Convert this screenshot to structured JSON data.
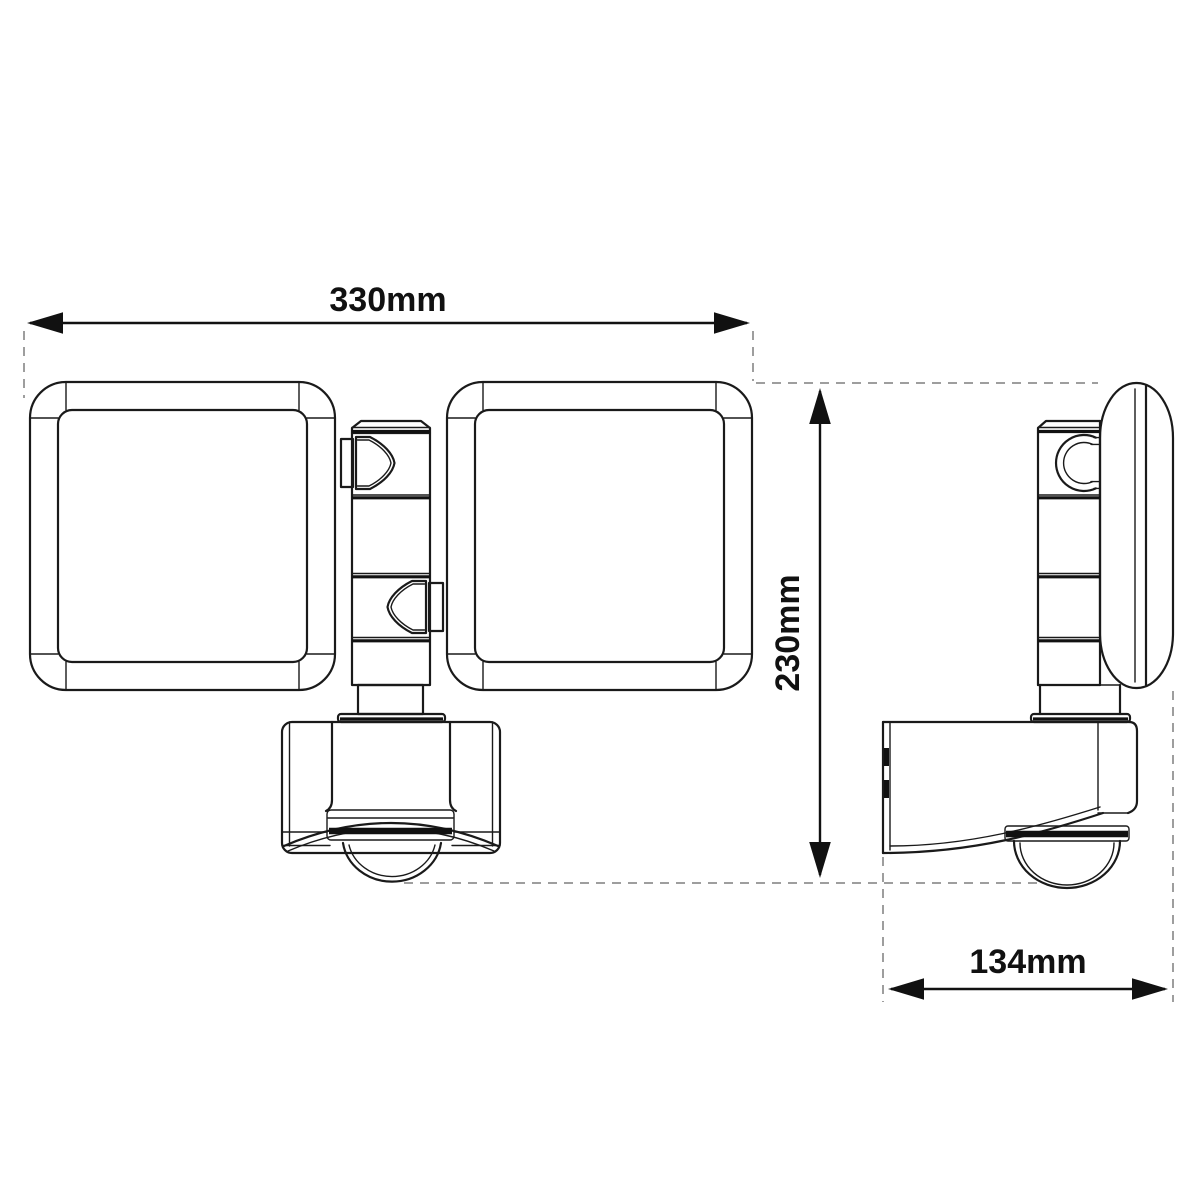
{
  "diagram": {
    "kind": "technical-dimension-drawing",
    "views": {
      "front_view": "dual-panel security floodlight with motion sensor, front",
      "side_view": "dual-panel security floodlight with motion sensor, side"
    },
    "dimensions": {
      "width_label": "330mm",
      "height_label": "230mm",
      "depth_label": "134mm"
    },
    "colors": {
      "line": "#1a1a1a",
      "dark_accent": "#111111",
      "extension_dashed": "#9e9e9e",
      "background": "#ffffff"
    }
  }
}
